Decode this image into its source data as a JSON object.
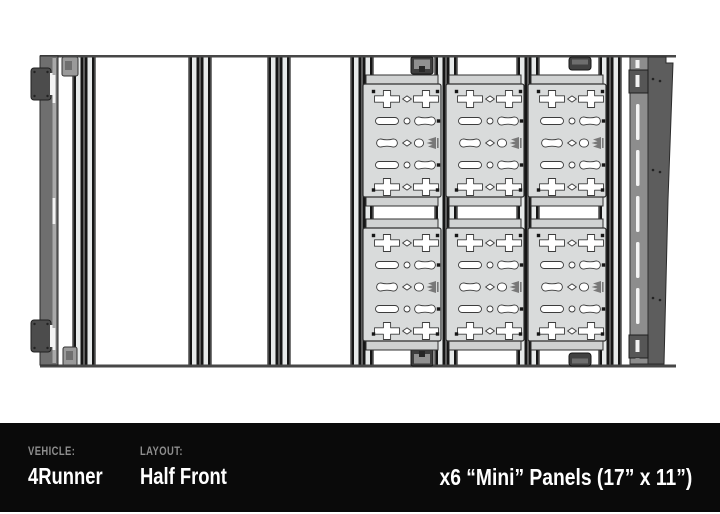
{
  "info_bar": {
    "bg_color": "#0a0a0a",
    "label_color": "#8e8e8e",
    "value_color": "#ffffff",
    "vehicle_label": "VEHICLE:",
    "vehicle_value": "4Runner",
    "layout_label": "LAYOUT:",
    "layout_value": "Half Front",
    "panels_text": "x6 “Mini” Panels (17” x 11”)"
  },
  "diagram": {
    "kind": "roof-rack-top-view",
    "panel_count": 6,
    "panel_grid": {
      "rows": 2,
      "cols": 3
    },
    "colors": {
      "frame_line": "#474747",
      "rail_light": "#e7eaea",
      "rail_dark": "#161616",
      "rail_mid": "#5f5f5f",
      "rail_edge": "#787878",
      "panel_fill": "#d9dbdb",
      "panel_flange": "#d0d2d2",
      "panel_stroke": "#303030",
      "hole_fill": "#ffffff",
      "hole_stroke": "#3c3c3c",
      "left_bar": "#6f6f6f",
      "left_bar_stripe": "#a9a9a9",
      "left_clamp": "#4c4c4c",
      "right_bar": "#8d8d8d",
      "wedge": "#5d5d5d",
      "clamp_dark": "#3d3d3d",
      "clamp_insert": "#909090",
      "slot_fill": "#f3f3f3",
      "screw": "#161616",
      "logo": "#787878"
    },
    "frame": {
      "x": 40,
      "y": 55,
      "w": 636,
      "top_h": 2.5,
      "bottom_y": 364.5,
      "bottom_h": 3
    },
    "rails": {
      "xs": [
        72,
        188,
        267,
        350,
        434,
        516,
        598
      ],
      "y": 57,
      "w": 24,
      "h": 309
    },
    "rail_tabs": [
      {
        "x": 62,
        "y": 57,
        "w": 16,
        "h": 19
      },
      {
        "x": 63,
        "y": 347,
        "w": 14,
        "h": 19
      }
    ],
    "left_bar": {
      "x": 40,
      "y": 56,
      "w": 18,
      "h": 309,
      "slots": [
        [
          75,
          28
        ],
        [
          198,
          26
        ],
        [
          328,
          22
        ]
      ],
      "clamps_y": [
        66,
        318
      ]
    },
    "right_bar": {
      "x": 630,
      "y": 57,
      "w": 18,
      "h": 307,
      "slots_y": [
        104,
        150,
        196,
        242,
        288
      ],
      "slot_h": 36,
      "clamps_y": [
        70,
        335
      ]
    },
    "wedge": {
      "points": "648,57 666,57 666,63 673,63 668,200 664,364 648,364",
      "bolts": [
        [
          653,
          79
        ],
        [
          660,
          81
        ],
        [
          653,
          170
        ],
        [
          660,
          172
        ],
        [
          653,
          298
        ],
        [
          660,
          300
        ]
      ]
    },
    "frame_clamps": [
      {
        "x": 411,
        "edge": "top",
        "style": "bracket"
      },
      {
        "x": 569,
        "edge": "top",
        "style": "handle"
      },
      {
        "x": 411,
        "edge": "bottom",
        "style": "bracket"
      },
      {
        "x": 569,
        "edge": "bottom",
        "style": "handle"
      }
    ],
    "panels": {
      "col_x": [
        363,
        446,
        528
      ],
      "row_y": [
        84,
        228
      ],
      "w": 78,
      "h": 113,
      "flange": 10,
      "hole_rows": [
        {
          "y": 15,
          "holes": [
            {
              "t": "plus",
              "x": 24
            },
            {
              "t": "diamond",
              "x": 44
            },
            {
              "t": "plus",
              "x": 63
            }
          ]
        },
        {
          "y": 37,
          "holes": [
            {
              "t": "pill",
              "x": 24
            },
            {
              "t": "circle",
              "x": 44
            },
            {
              "t": "bumps",
              "x": 62
            }
          ]
        },
        {
          "y": 59,
          "holes": [
            {
              "t": "bumps",
              "x": 24
            },
            {
              "t": "diamond",
              "x": 44
            },
            {
              "t": "blob",
              "x": 56
            },
            {
              "t": "logo",
              "x": 69
            }
          ]
        },
        {
          "y": 81,
          "holes": [
            {
              "t": "pill",
              "x": 24
            },
            {
              "t": "circle",
              "x": 44
            },
            {
              "t": "bumps",
              "x": 62
            }
          ]
        },
        {
          "y": 103,
          "holes": [
            {
              "t": "plus",
              "x": 24
            },
            {
              "t": "diamond",
              "x": 44
            },
            {
              "t": "plus",
              "x": 63
            }
          ]
        }
      ],
      "screws": [
        [
          10.5,
          7.5
        ],
        [
          74.5,
          7.5
        ],
        [
          10.5,
          106
        ],
        [
          74.5,
          106
        ],
        [
          75.5,
          37
        ],
        [
          75.5,
          81
        ]
      ]
    }
  }
}
